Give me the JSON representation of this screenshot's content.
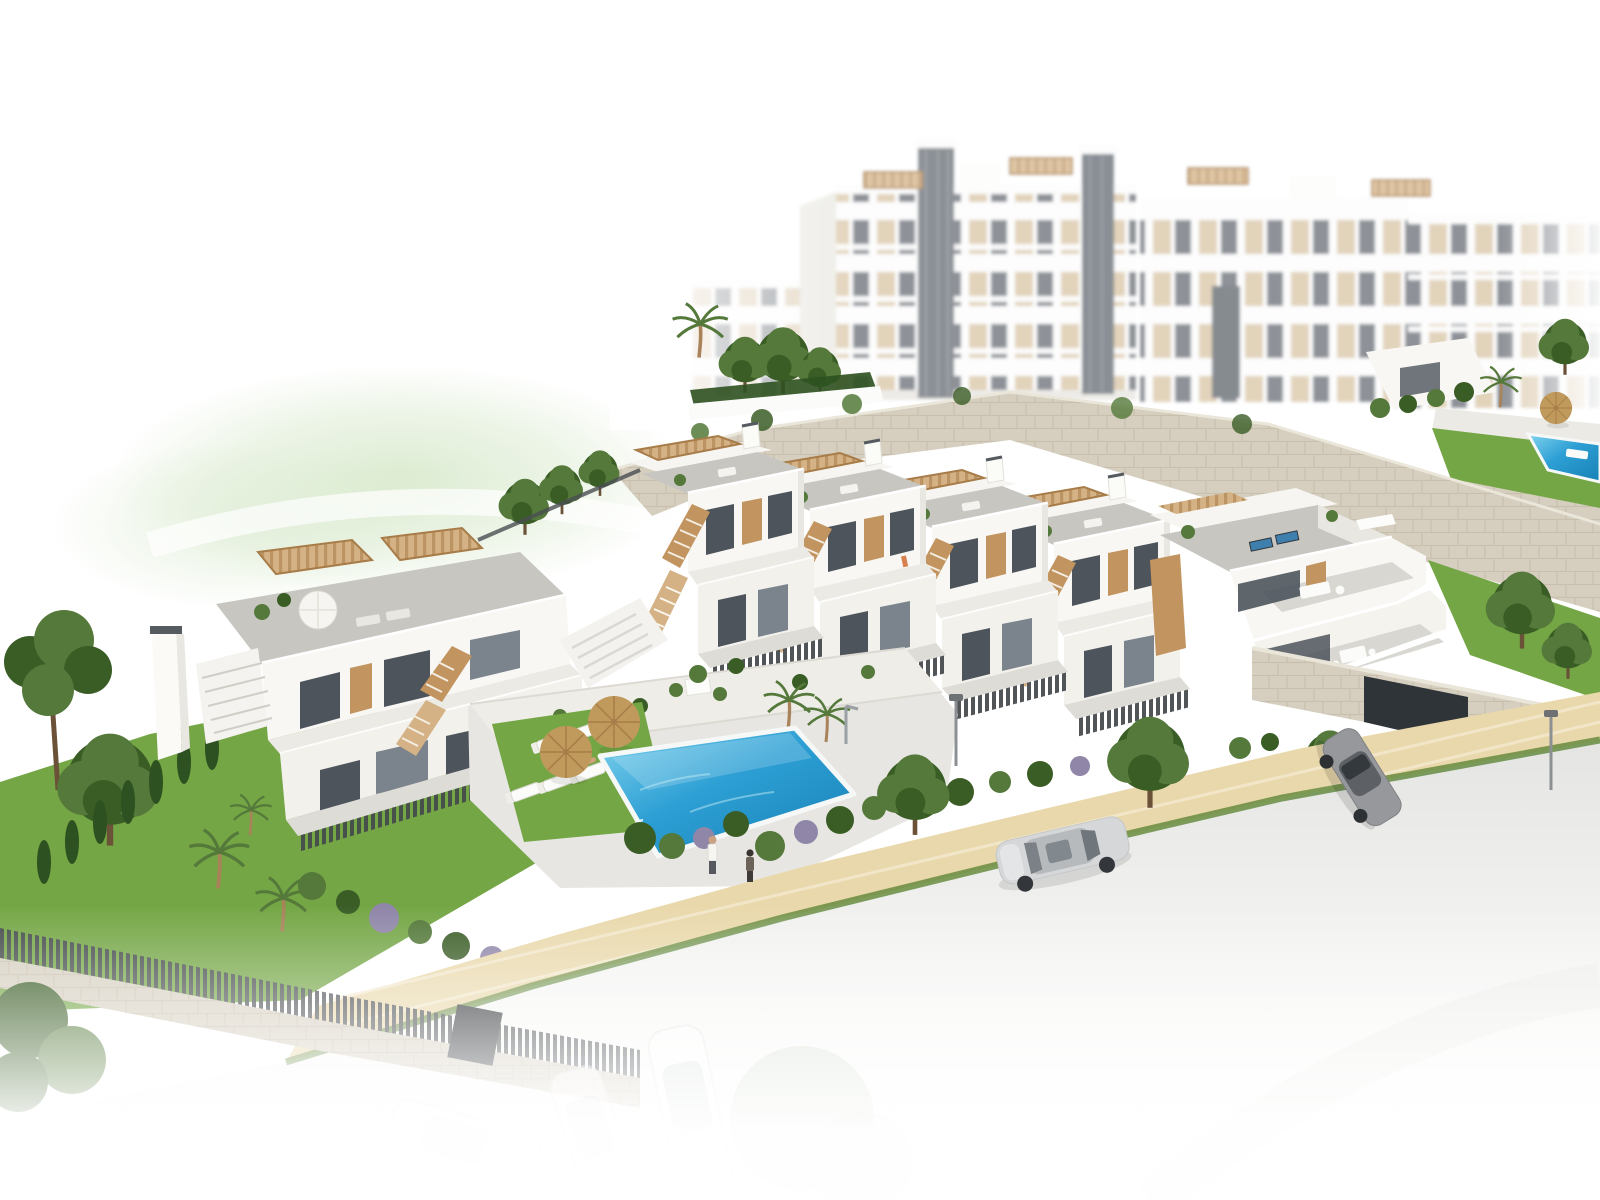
{
  "scene": {
    "type": "architectural-3d-render",
    "description": "Aerial 3D rendering of a modern white hillside residential development: large apartment blocks with beige panels in the hazy background, a natural stone retaining wall, a diagonal row of five white townhouses with tan wooden staircases, pergolas and rooftop terraces, a two-storey apartment building on the left, a communal blue swimming pool with white sun loungers and straw parasols, landscaped gardens with lawns, palms and cypresses, a sandy paved walkway with two pedestrians, and a street with parked cars fading to white at the bottom edge.",
    "style": "bright daylight, edges faded to white"
  },
  "colors": {
    "white": "#ffffff",
    "facade": "#f8f7f4",
    "facadeShade": "#e9e7e1",
    "roofDeck": "#c7c6c1",
    "roofLight": "#d8d7d2",
    "windowDark": "#4d545c",
    "glass": "#7b838c",
    "tan": "#c2945f",
    "tanDark": "#a87c48",
    "tanLight": "#d4b285",
    "beige": "#d8c4a4",
    "stone": "#d6cfc0",
    "stoneLine": "#bdb29a",
    "grass": "#74a645",
    "grassDark": "#55802f",
    "tree": "#54793a",
    "treeDark": "#3a5d26",
    "cypress": "#2d5120",
    "poolLight": "#82d4ef",
    "poolMid": "#2d9fd4",
    "poolDeep": "#1781b5",
    "sand": "#e9d8ab",
    "sandLight": "#f4ead0",
    "road": "#e3e3e1",
    "fence": "#42464a",
    "carSilver": "#d6d7d8",
    "carGray": "#96989b",
    "umbrella": "#c09a5c",
    "skin": "#d3a07c",
    "hill": "#d8e9cc",
    "poolLoungerBlue": "#3f7fae"
  },
  "inventory": {
    "background_apartment_blocks": 3,
    "elevator_towers": 2,
    "townhouse_units": 5,
    "left_building_units": 2,
    "community_pools": 2,
    "pool_sun_loungers": 6,
    "straw_parasols": 2,
    "rooftop_blue_loungers": 2,
    "people_on_path": 2,
    "visible_cars": 2,
    "faded_parked_cars": 3,
    "street_lamps": 2,
    "garage_entrances": 1
  }
}
